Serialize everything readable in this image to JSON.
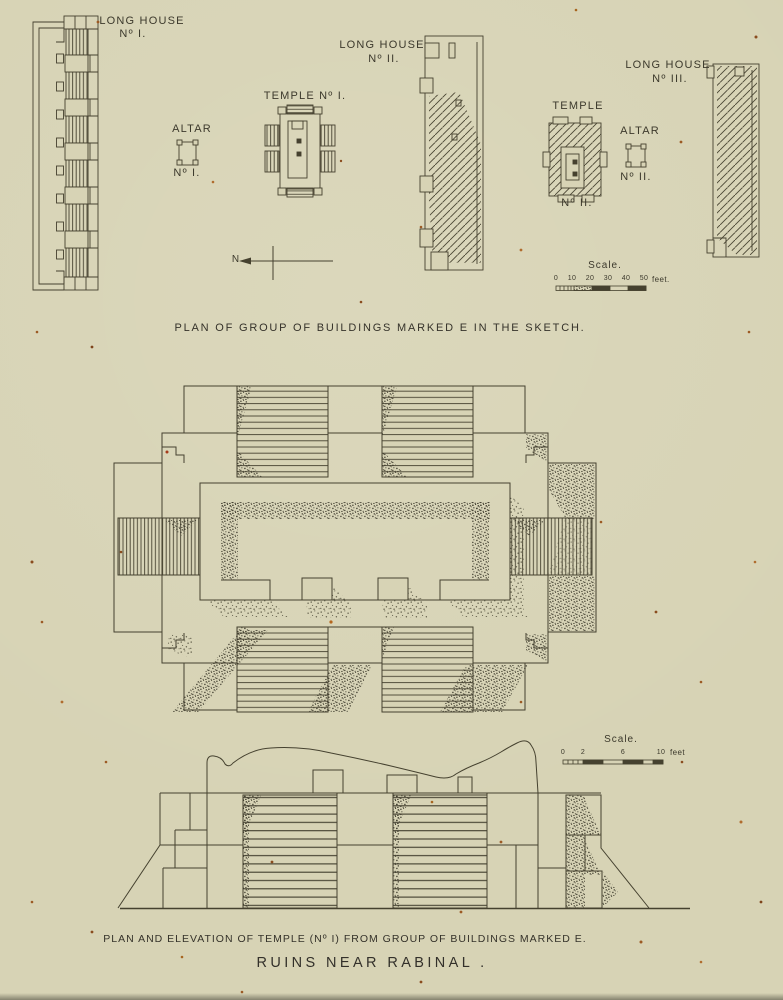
{
  "page": {
    "caption_plan": "PLAN OF GROUP OF BUILDINGS MARKED E IN THE SKETCH.",
    "caption_elevation": "PLAN AND ELEVATION OF TEMPLE (Nº I) FROM GROUP OF BUILDINGS MARKED E.",
    "title": "RUINS NEAR RABINAL ."
  },
  "labels": {
    "long_house_1": {
      "name": "LONG HOUSE",
      "number": "Nº I."
    },
    "altar_1": {
      "name": "ALTAR",
      "number": "Nº I."
    },
    "temple_1": {
      "name": "TEMPLE Nº I."
    },
    "long_house_2": {
      "name": "LONG HOUSE",
      "number": "Nº II."
    },
    "temple_2": {
      "name": "TEMPLE",
      "number": "Nº II."
    },
    "altar_2": {
      "name": "ALTAR",
      "number": "Nº II."
    },
    "long_house_3": {
      "name": "LONG HOUSE",
      "number": "Nº III."
    },
    "north": "N"
  },
  "scales": {
    "plan": {
      "title": "Scale.",
      "ticks": [
        "0",
        "10",
        "20",
        "30",
        "40",
        "50"
      ],
      "unit": "feet."
    },
    "elevation": {
      "title": "Scale.",
      "ticks": [
        "0",
        "2",
        "6",
        "10"
      ],
      "unit": "feet"
    }
  },
  "colors": {
    "paper": "#d7d3b5",
    "ink": "#45412f",
    "foxing": "#9c5a24"
  }
}
